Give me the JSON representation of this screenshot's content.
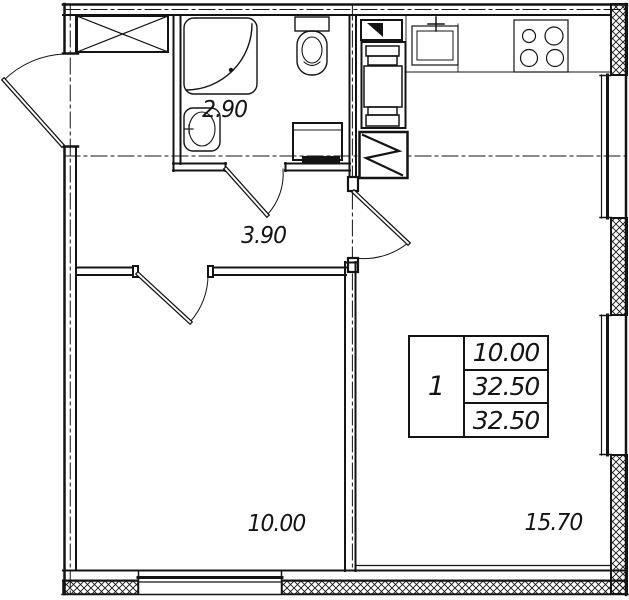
{
  "colors": {
    "ink": "#141414",
    "paper": "#ffffff"
  },
  "plan": {
    "rooms": [
      {
        "name": "bathroom",
        "area": "2.90"
      },
      {
        "name": "hallway",
        "area": "3.90"
      },
      {
        "name": "bedroom",
        "area": "10.00"
      },
      {
        "name": "kitchen-living",
        "area": "15.70"
      }
    ],
    "apartment_table": {
      "rooms_count": "1",
      "rows": [
        "10.00",
        "32.50",
        "32.50"
      ]
    }
  }
}
